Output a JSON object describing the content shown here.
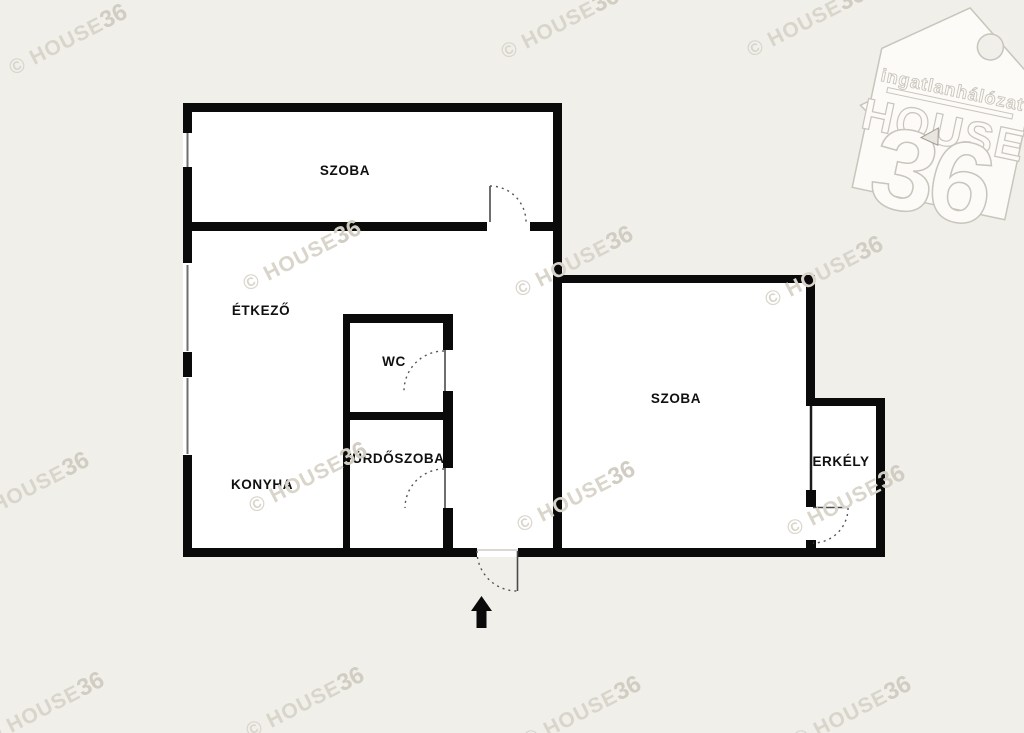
{
  "colors": {
    "background": "#f0efe9",
    "wall": "#0a0a0a",
    "room_fill": "#ffffff",
    "watermark": "#d9d5cb",
    "logo_outline": "#c9c5bc"
  },
  "rooms": {
    "szoba_top": "SZOBA",
    "etkezo": "ÉTKEZŐ",
    "wc": "WC",
    "furdoszoba": "FÜRDŐSZOBA",
    "konyha": "KONYHA",
    "szoba_right": "SZOBA",
    "erkely": "ERKÉLY"
  },
  "watermark": {
    "prefix": "© HOUSE",
    "suffix": "36"
  },
  "logo": {
    "network": "ingatlanhálózat",
    "name": "HOUSE",
    "number": "36"
  }
}
